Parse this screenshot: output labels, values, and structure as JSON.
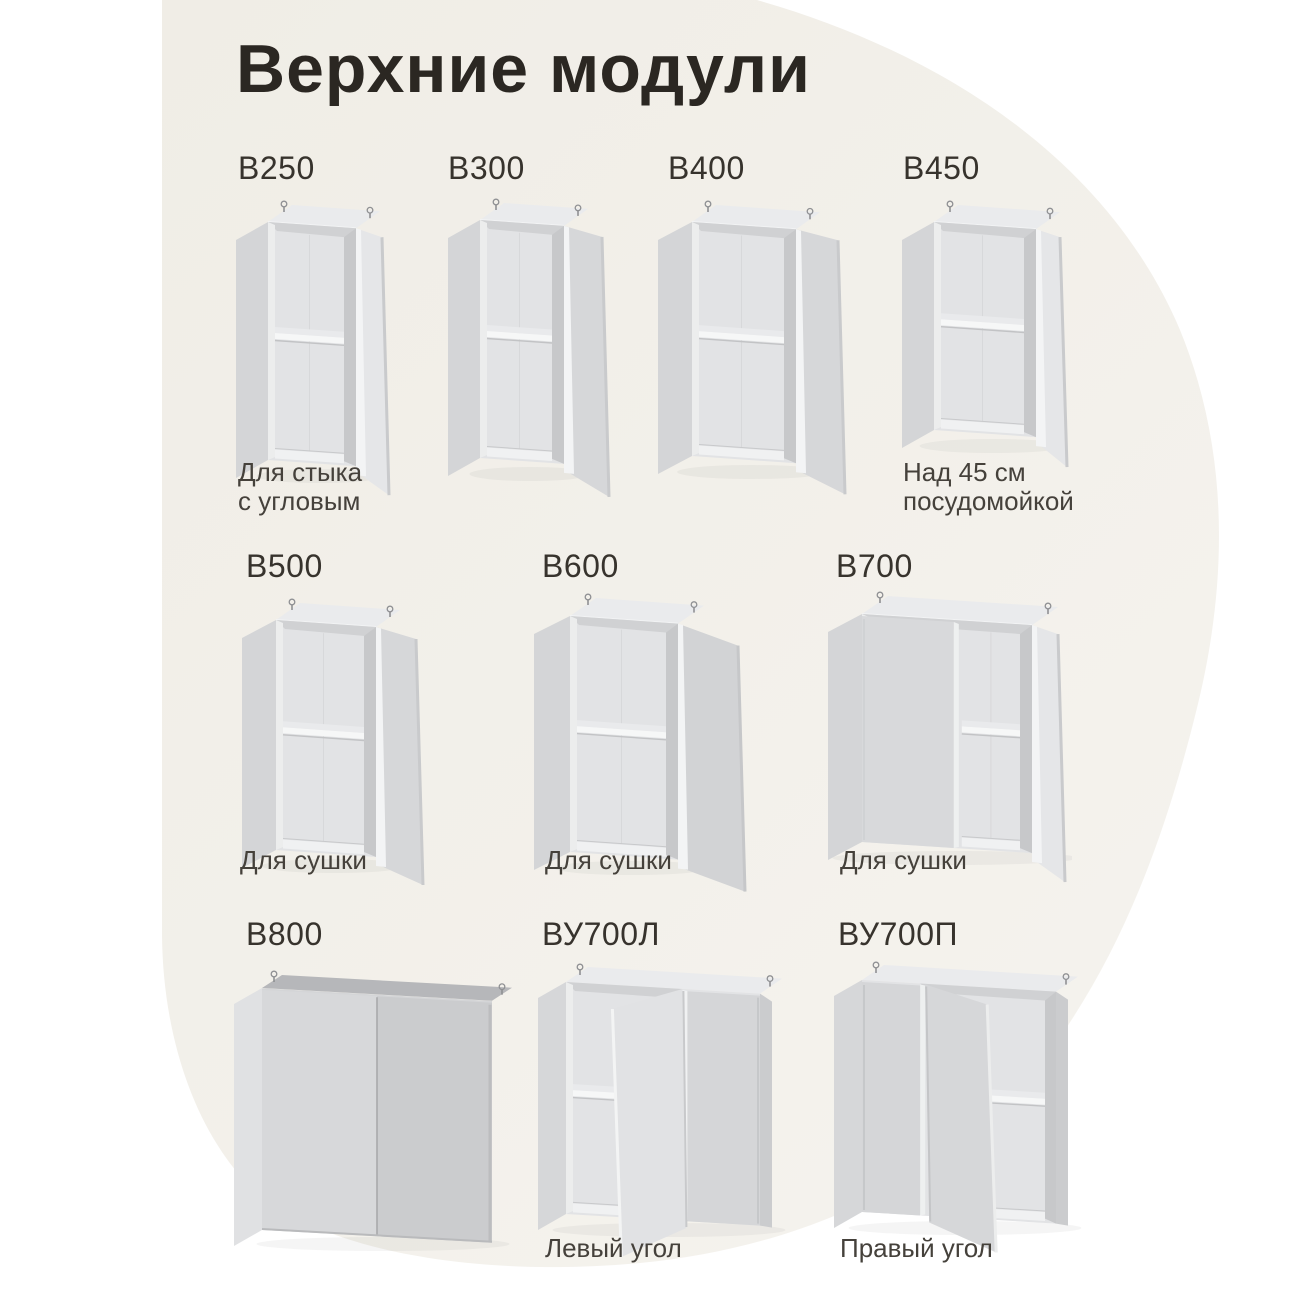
{
  "page": {
    "title": "Верхние модули"
  },
  "colors": {
    "page_background": "#ffffff",
    "blob_background": "#f1eee8",
    "title_color": "#2b2722",
    "label_color": "#37332d",
    "caption_color": "#45413b",
    "cabinet_gray": "#d5d6d8"
  },
  "modules": [
    {
      "id": "b250",
      "label": "В250",
      "caption": "Для стыка\nс угловым"
    },
    {
      "id": "b300",
      "label": "В300",
      "caption": ""
    },
    {
      "id": "b400",
      "label": "В400",
      "caption": ""
    },
    {
      "id": "b450",
      "label": "В450",
      "caption": "Над 45 см\nпосудомойкой"
    },
    {
      "id": "b500",
      "label": "В500",
      "caption": "Для сушки"
    },
    {
      "id": "b600",
      "label": "В600",
      "caption": "Для сушки"
    },
    {
      "id": "b700",
      "label": "В700",
      "caption": "Для сушки"
    },
    {
      "id": "b800",
      "label": "В800",
      "caption": ""
    },
    {
      "id": "vu700l",
      "label": "ВУ700Л",
      "caption": "Левый угол"
    },
    {
      "id": "vu700p",
      "label": "ВУ700П",
      "caption": "Правый угол"
    }
  ]
}
